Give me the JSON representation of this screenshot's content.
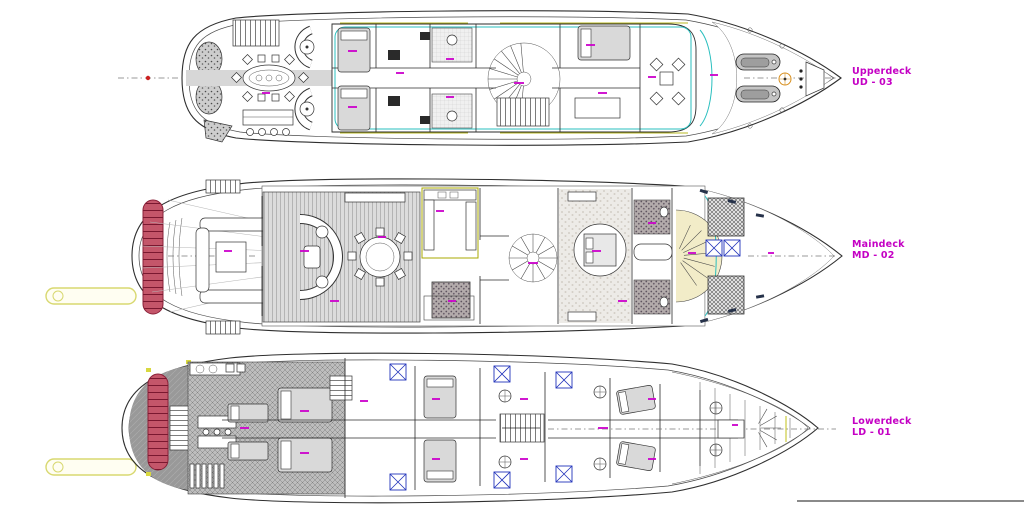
{
  "page": {
    "type": "yacht-general-arrangement-drawing",
    "background": "#ffffff"
  },
  "decks": [
    {
      "name": "Upperdeck",
      "code": "UD - 03"
    },
    {
      "name": "Maindeck",
      "code": "MD - 02"
    },
    {
      "name": "Lowerdeck",
      "code": "LD - 01"
    }
  ],
  "colors": {
    "label_magenta": "#c400c4",
    "deck_gray": "#9a9a9a",
    "swim_ladder_red": "#c4566a",
    "passerelle_yellow": "#d8d870",
    "accent_cyan": "#2abfbf",
    "accent_olive": "#b8b820",
    "hatch_box_blue": "#2233bb",
    "centerline_red_dot": "#cc2222"
  }
}
